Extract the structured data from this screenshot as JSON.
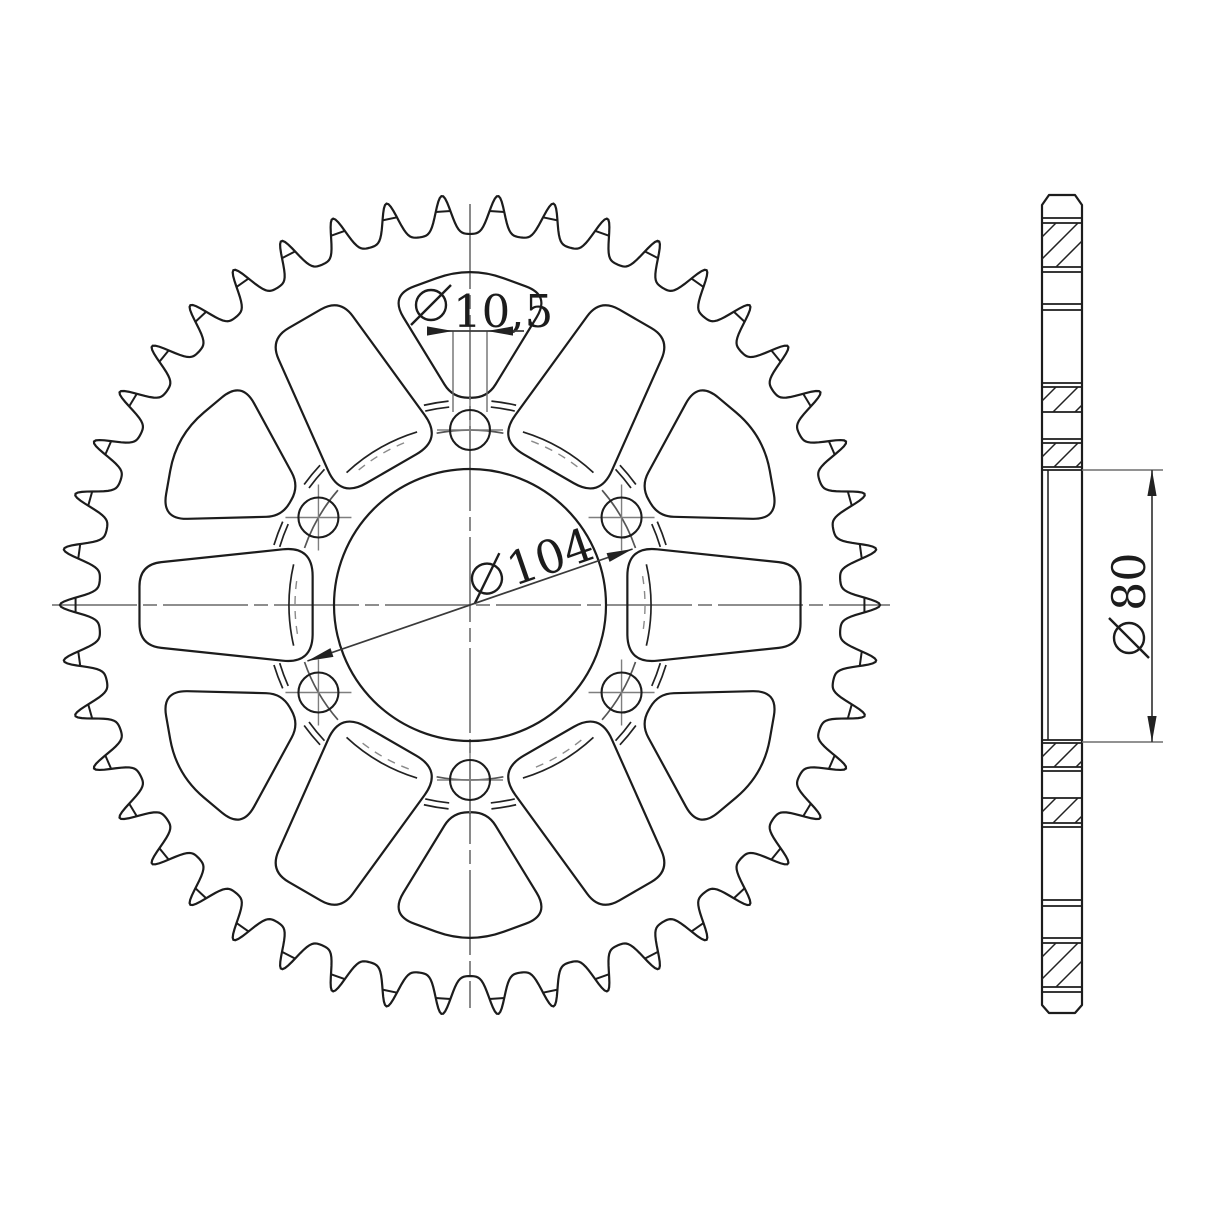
{
  "drawing": {
    "type": "technical-drawing",
    "subject": "rear-sprocket",
    "views": {
      "front": "sprocket-front-view",
      "side": "sprocket-section-view"
    }
  },
  "sprocket": {
    "teeth": 46,
    "bolt_holes": 6,
    "lightening_triangles": 6,
    "lightening_slots": 6
  },
  "dimensions": {
    "bolt_hole_diameter": {
      "symbol": "diameter",
      "value": "10,5"
    },
    "bolt_circle_diameter": {
      "symbol": "diameter",
      "value": "104"
    },
    "bore_diameter": {
      "symbol": "diameter",
      "value": "80"
    }
  },
  "colors": {
    "background": "#ffffff",
    "outline": "#1c1c1c",
    "centerline": "#7e7e7e",
    "dimension_line": "#3a3a3a",
    "extension_line": "#6e6e6e",
    "hidden_line": "#8a8a8a"
  }
}
